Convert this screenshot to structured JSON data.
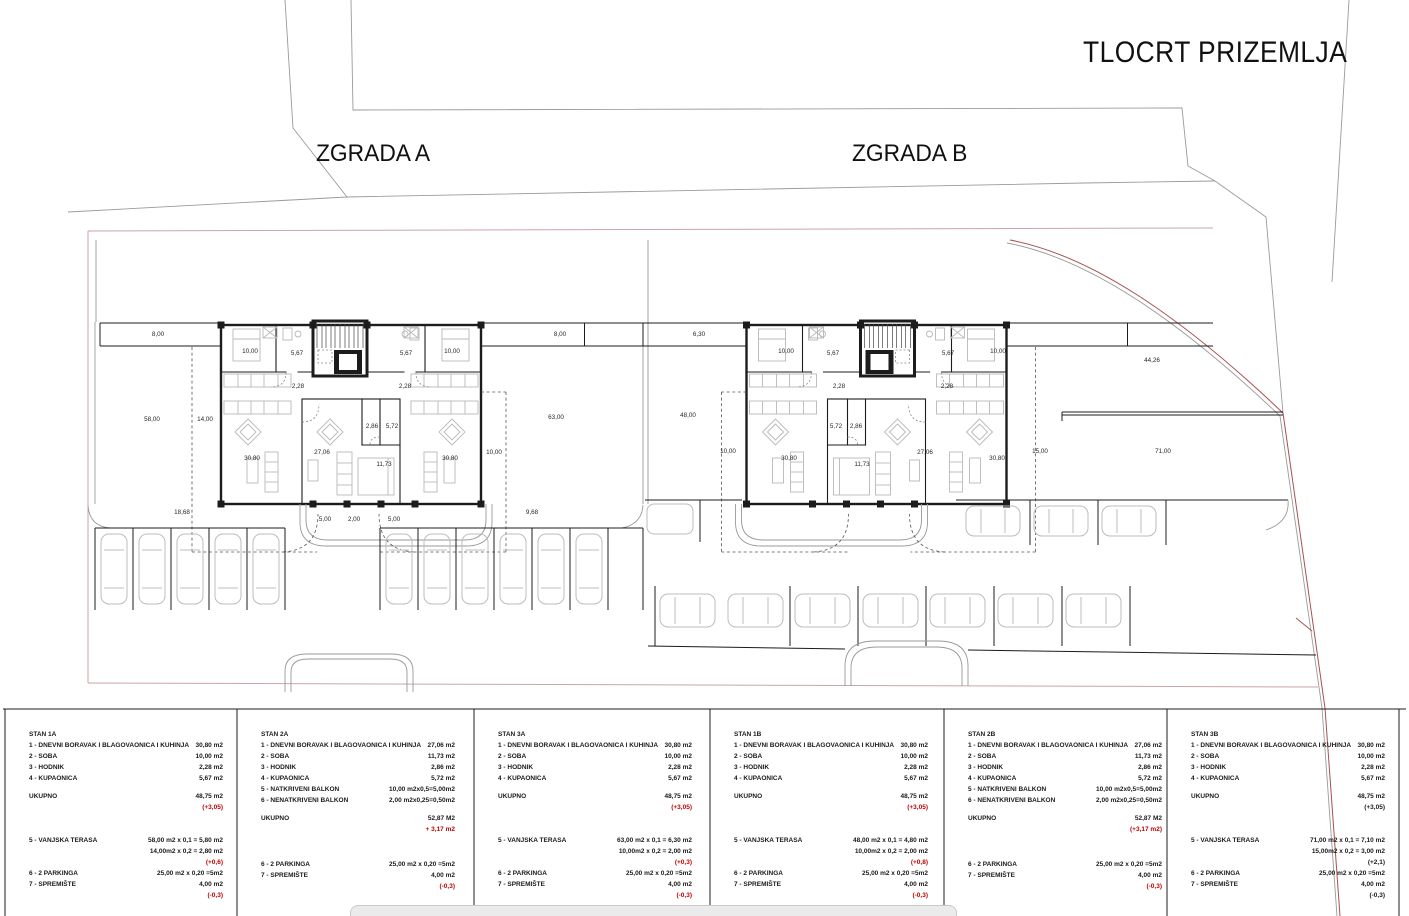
{
  "title": "TLOCRT PRIZEMLJA",
  "building_labels": {
    "a": "ZGRADA A",
    "b": "ZGRADA B"
  },
  "colors": {
    "red_text": "#c00000",
    "parcel_line_red": "#a85151",
    "site_boundary_pink": "#c9a6a6",
    "wall_black": "#1c1c1c"
  },
  "plan": {
    "dimension_labels": [
      {
        "t": "8,00",
        "x": 158,
        "y": 336
      },
      {
        "t": "8,00",
        "x": 560,
        "y": 336
      },
      {
        "t": "10,00",
        "x": 250,
        "y": 353
      },
      {
        "t": "5,67",
        "x": 297,
        "y": 355
      },
      {
        "t": "5,67",
        "x": 406,
        "y": 355
      },
      {
        "t": "10,00",
        "x": 452,
        "y": 353
      },
      {
        "t": "2,28",
        "x": 298,
        "y": 388
      },
      {
        "t": "2,28",
        "x": 405,
        "y": 388
      },
      {
        "t": "58,00",
        "x": 152,
        "y": 421
      },
      {
        "t": "14,00",
        "x": 205,
        "y": 421
      },
      {
        "t": "30,80",
        "x": 252,
        "y": 460
      },
      {
        "t": "27,06",
        "x": 322,
        "y": 454
      },
      {
        "t": "2,86",
        "x": 372,
        "y": 428
      },
      {
        "t": "5,72",
        "x": 392,
        "y": 428
      },
      {
        "t": "11,73",
        "x": 384,
        "y": 466
      },
      {
        "t": "30,80",
        "x": 450,
        "y": 460
      },
      {
        "t": "10,00",
        "x": 494,
        "y": 454
      },
      {
        "t": "63,00",
        "x": 556,
        "y": 419
      },
      {
        "t": "18,68",
        "x": 182,
        "y": 514
      },
      {
        "t": "5,00",
        "x": 325,
        "y": 521
      },
      {
        "t": "2,00",
        "x": 354,
        "y": 521
      },
      {
        "t": "5,00",
        "x": 394,
        "y": 521
      },
      {
        "t": "9,68",
        "x": 532,
        "y": 514
      },
      {
        "t": "6,30",
        "x": 699,
        "y": 336
      },
      {
        "t": "10,00",
        "x": 786,
        "y": 353
      },
      {
        "t": "5,67",
        "x": 833,
        "y": 355
      },
      {
        "t": "5,67",
        "x": 948,
        "y": 355
      },
      {
        "t": "10,00",
        "x": 998,
        "y": 353
      },
      {
        "t": "2,28",
        "x": 839,
        "y": 388
      },
      {
        "t": "2,28",
        "x": 947,
        "y": 388
      },
      {
        "t": "48,00",
        "x": 688,
        "y": 417
      },
      {
        "t": "10,00",
        "x": 728,
        "y": 453
      },
      {
        "t": "30,80",
        "x": 789,
        "y": 460
      },
      {
        "t": "5,72",
        "x": 836,
        "y": 428
      },
      {
        "t": "2,86",
        "x": 856,
        "y": 428
      },
      {
        "t": "11,73",
        "x": 862,
        "y": 466
      },
      {
        "t": "27,06",
        "x": 925,
        "y": 454
      },
      {
        "t": "30,80",
        "x": 997,
        "y": 460
      },
      {
        "t": "15,00",
        "x": 1040,
        "y": 453
      },
      {
        "t": "44,26",
        "x": 1152,
        "y": 362
      },
      {
        "t": "71,00",
        "x": 1163,
        "y": 453
      }
    ]
  },
  "legend": {
    "panels": [
      {
        "title": "STAN 1A",
        "rows": [
          {
            "l": "1 - DNEVNI BORAVAK I BLAGOVAONICA I KUHINJA",
            "v": "30,80 m2"
          },
          {
            "l": "2 - SOBA",
            "v": "10,00 m2"
          },
          {
            "l": "3 - HODNIK",
            "v": "2,28 m2"
          },
          {
            "l": "4 - KUPAONICA",
            "v": "5,67 m2"
          },
          {
            "gap": 7
          },
          {
            "l": "UKUPNO",
            "v": "48,75 m2"
          },
          {
            "l": "",
            "v": "(+3,05)",
            "red": true
          },
          {
            "gap": 22
          },
          {
            "l": "5 - VANJSKA TERASA",
            "v": "58,00 m2 x 0,1 = 5,80 m2"
          },
          {
            "l": "",
            "v": "14,00m2 x 0,2 = 2,80 m2"
          },
          {
            "l": "",
            "v": "(+0,6)",
            "red": true
          },
          {
            "l": "6 - 2 PARKINGA",
            "v": "25,00 m2  x 0,20 =5m2"
          },
          {
            "l": "7 - SPREMIŠTE",
            "v": "4,00 m2"
          },
          {
            "l": "",
            "v": "(-0,3)",
            "red": true
          }
        ]
      },
      {
        "title": "STAN 2A",
        "rows": [
          {
            "l": "1 - DNEVNI BORAVAK I BLAGOVAONICA I KUHINJA",
            "v": "27,06 m2"
          },
          {
            "l": "2 - SOBA",
            "v": "11,73 m2"
          },
          {
            "l": "3 - HODNIK",
            "v": "2,86 m2"
          },
          {
            "l": "4 - KUPAONICA",
            "v": "5,72 m2"
          },
          {
            "l": "5 - NATKRIVENI BALKON",
            "v": "10,00 m2x0,5=5,00m2"
          },
          {
            "l": "6 - NENATKRIVENI BALKON",
            "v": "2,00 m2x0,25=0,50m2"
          },
          {
            "gap": 7
          },
          {
            "l": "UKUPNO",
            "v": "52,87 M2"
          },
          {
            "l": "",
            "v": "+ 3,17 m2",
            "red": true
          },
          {
            "gap": 24
          },
          {
            "l": "6 - 2 PARKINGA",
            "v": "25,00 m2  x 0,20 =5m2"
          },
          {
            "l": "7 - SPREMIŠTE",
            "v": "4,00 m2"
          },
          {
            "l": "",
            "v": "(-0,3)",
            "red": true
          }
        ]
      },
      {
        "title": "STAN 3A",
        "rows": [
          {
            "l": "1 - DNEVNI BORAVAK I BLAGOVAONICA I KUHINJA",
            "v": "30,80 m2"
          },
          {
            "l": "2 - SOBA",
            "v": "10,00 m2"
          },
          {
            "l": "3 - HODNIK",
            "v": "2,28 m2"
          },
          {
            "l": "4 - KUPAONICA",
            "v": "5,67 m2"
          },
          {
            "gap": 7
          },
          {
            "l": "UKUPNO",
            "v": "48,75 m2"
          },
          {
            "l": "",
            "v": "(+3,05)",
            "red": true
          },
          {
            "gap": 22
          },
          {
            "l": "5 - VANJSKA TERASA",
            "v": "63,00 m2 x 0,1 = 6,30 m2"
          },
          {
            "l": "",
            "v": "10,00m2 x 0,2 = 2,00 m2"
          },
          {
            "l": "",
            "v": "(+0,3)",
            "red": true
          },
          {
            "l": "6 - 2 PARKINGA",
            "v": "25,00 m2  x 0,20 =5m2"
          },
          {
            "l": "7 - SPREMIŠTE",
            "v": "4,00 m2"
          },
          {
            "l": "",
            "v": "(-0,3)",
            "red": true
          }
        ]
      },
      {
        "title": "STAN 1B",
        "rows": [
          {
            "l": "1 - DNEVNI BORAVAK I BLAGOVAONICA I KUHINJA",
            "v": "30,80 m2"
          },
          {
            "l": "2 - SOBA",
            "v": "10,00 m2"
          },
          {
            "l": "3 - HODNIK",
            "v": "2,28 m2"
          },
          {
            "l": "4 - KUPAONICA",
            "v": "5,67 m2"
          },
          {
            "gap": 7
          },
          {
            "l": "UKUPNO",
            "v": "48,75 m2"
          },
          {
            "l": "",
            "v": "(+3,05)",
            "red": true
          },
          {
            "gap": 22
          },
          {
            "l": "5 - VANJSKA TERASA",
            "v": "48,00 m2 x 0,1 = 4,80 m2"
          },
          {
            "l": "",
            "v": "10,00m2 x 0,2 = 2,00 m2"
          },
          {
            "l": "",
            "v": "(+0,8)",
            "red": true
          },
          {
            "l": "6 - 2 PARKINGA",
            "v": "25,00 m2  x 0,20 =5m2"
          },
          {
            "l": "7 - SPREMIŠTE",
            "v": "4,00 m2"
          },
          {
            "l": "",
            "v": "(-0,3)",
            "red": true
          }
        ]
      },
      {
        "title": "STAN 2B",
        "rows": [
          {
            "l": "1 - DNEVNI BORAVAK I BLAGOVAONICA I KUHINJA",
            "v": "27,06 m2"
          },
          {
            "l": "2 - SOBA",
            "v": "11,73 m2"
          },
          {
            "l": "3 - HODNIK",
            "v": "2,86 m2"
          },
          {
            "l": "4 - KUPAONICA",
            "v": "5,72 m2"
          },
          {
            "l": "5 - NATKRIVENI BALKON",
            "v": "10,00 m2x0,5=5,00m2"
          },
          {
            "l": "6 - NENATKRIVENI BALKON",
            "v": "2,00 m2x0,25=0,50m2"
          },
          {
            "gap": 7
          },
          {
            "l": "UKUPNO",
            "v": "52,87 M2"
          },
          {
            "l": "",
            "v": "(+3,17 m2)",
            "red": true
          },
          {
            "gap": 24
          },
          {
            "l": "6 - 2 PARKINGA",
            "v": "25,00 m2  x 0,20 =5m2"
          },
          {
            "l": "7 - SPREMIŠTE",
            "v": "4,00 m2"
          },
          {
            "l": "",
            "v": "(-0,3)",
            "red": true
          }
        ]
      },
      {
        "title": "STAN 3B",
        "rows": [
          {
            "l": "1 - DNEVNI BORAVAK I BLAGOVAONICA I KUHINJA",
            "v": "30,80 m2"
          },
          {
            "l": "2 - SOBA",
            "v": "10,00 m2"
          },
          {
            "l": "3 - HODNIK",
            "v": "2,28 m2"
          },
          {
            "l": "4 - KUPAONICA",
            "v": "5,67 m2"
          },
          {
            "gap": 7
          },
          {
            "l": "UKUPNO",
            "v": "48,75 m2"
          },
          {
            "l": "",
            "v": "(+3,05)"
          },
          {
            "gap": 22
          },
          {
            "l": "5 - VANJSKA TERASA",
            "v": "71,00 m2 x 0,1 = 7,10 m2"
          },
          {
            "l": "",
            "v": "15,00m2 x 0,2 = 3,00 m2"
          },
          {
            "l": "",
            "v": "(+2,1)"
          },
          {
            "l": "6 - 2 PARKINGA",
            "v": "25,00 m2  x 0,20 =5m2"
          },
          {
            "l": "7 - SPREMIŠTE",
            "v": "4,00 m2"
          },
          {
            "l": "",
            "v": "(-0,3)"
          }
        ]
      }
    ]
  }
}
